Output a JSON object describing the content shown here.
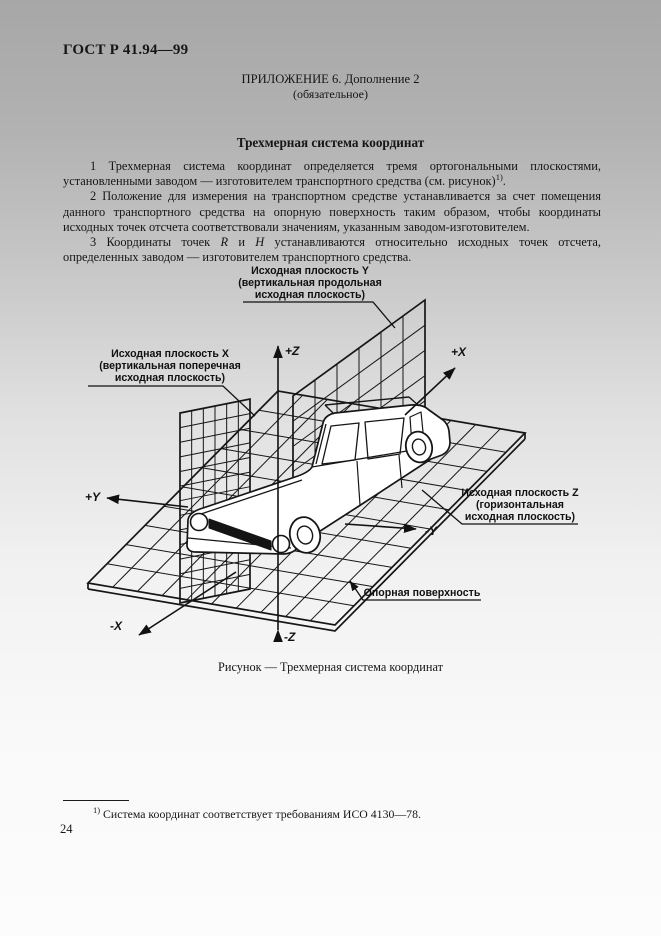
{
  "page": {
    "doc_number": "ГОСТ Р 41.94—99",
    "appendix_line1": "ПРИЛОЖЕНИЕ 6. Дополнение 2",
    "appendix_line2": "(обязательное)",
    "title": "Трехмерная система координат",
    "page_number": "24"
  },
  "paragraphs": {
    "p1": {
      "text": "1 Трехмерная система координат определяется тремя ортогональными плоскостями, установленными заводом — изготовителем транспортного средства (см. рисунок)",
      "sup": "1)",
      "tail": "."
    },
    "p2": {
      "text": "2 Положение для измерения на транспортном средстве устанавливается за счет помещения данного транспортного средства на опорную поверхность таким образом, чтобы координаты исходных точек отсчета соответствовали значениям, указанным заводом-изготовителем."
    },
    "p3": {
      "lead": "3 Координаты точек ",
      "var1": "R",
      "mid": " и ",
      "var2": "H",
      "tail": " устанавливаются относительно исходных точек отсчета, определенных заводом — изготовителем транспортного средства."
    }
  },
  "diagram": {
    "caption": "Рисунок — Трехмерная система координат",
    "labels": {
      "plane_y": [
        "Исходная плоскость Y",
        "(вертикальная продольная",
        "исходная плоскость)"
      ],
      "plane_x": [
        "Исходная плоскость X",
        "(вертикальная поперечная",
        "исходная плоскость)"
      ],
      "plane_z": [
        "Исходная плоскость Z",
        "(горизонтальная",
        "исходная плоскость)"
      ],
      "support_surface": "Опорная поверхность"
    },
    "axes": {
      "up": "+Z",
      "down": "-Z",
      "forward": "+X",
      "backward": "-X",
      "left": "+Y",
      "right": "-Y"
    }
  },
  "footnote": {
    "sup": "1)",
    "text": " Система координат соответствует требованиям ИСО 4130—78."
  }
}
